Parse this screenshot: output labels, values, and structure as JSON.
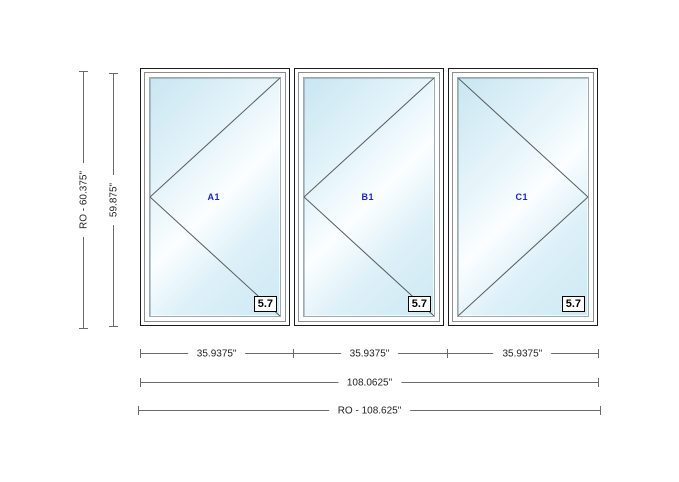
{
  "drawing": {
    "title": "window-unit-elevation",
    "panels": [
      {
        "label": "A1",
        "rating": "5.7",
        "swing": "left"
      },
      {
        "label": "B1",
        "rating": "5.7",
        "swing": "left"
      },
      {
        "label": "C1",
        "rating": "5.7",
        "swing": "right"
      }
    ],
    "dimensions": {
      "vertical_rough_opening": "RO - 60.375\"",
      "vertical_frame": "59.875\"",
      "panel_widths": [
        "35.9375\"",
        "35.9375\"",
        "35.9375\""
      ],
      "overall_frame_width": "108.0625\"",
      "horizontal_rough_opening": "RO - 108.625\""
    },
    "colors": {
      "panel_label": "#1d23c8",
      "glass_tint": "#cde9f3",
      "dimension_line": "#6b6b6b",
      "frame_outline": "#1c1c1c"
    }
  }
}
